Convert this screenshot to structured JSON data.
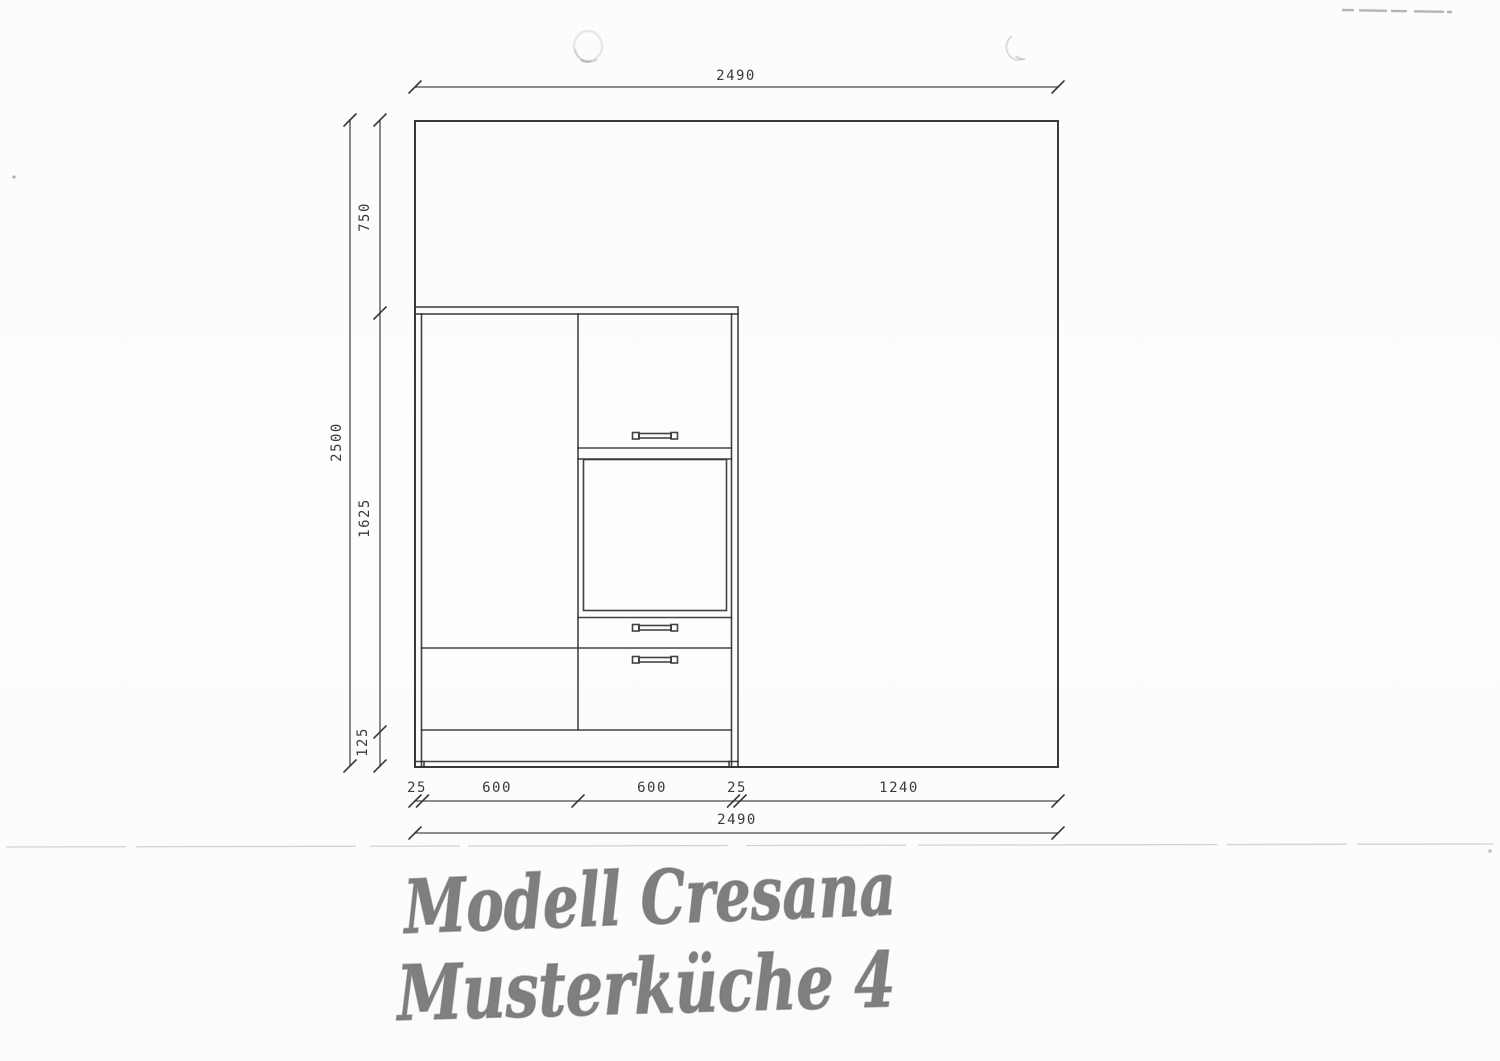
{
  "document": {
    "type": "scanned kitchen elevation drawing"
  },
  "dims": {
    "top_total": "2490",
    "left_total": "2500",
    "left_top": "750",
    "left_mid": "1625",
    "left_bottom": "125",
    "bottom_s1": "25",
    "bottom_s2": "600",
    "bottom_s3": "600",
    "bottom_s4": "25",
    "bottom_s5": "1240",
    "bottom_total": "2490"
  },
  "handwriting": {
    "line1": "Modell Cresana",
    "line2": "Musterküche 4"
  },
  "colors": {
    "ink": "#333333",
    "paper": "#fcfcfb",
    "marker_pen": "#6d6d6d",
    "scan_artifact": "#cdcdcd"
  }
}
